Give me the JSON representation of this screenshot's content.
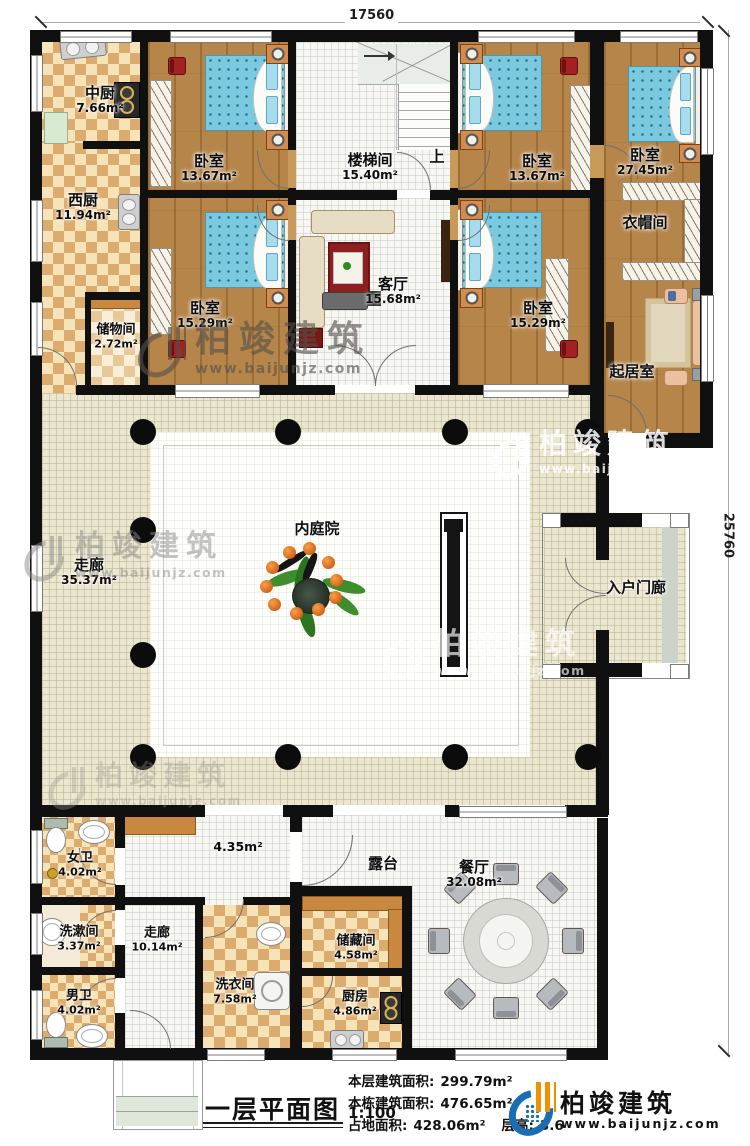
{
  "dimensions": {
    "top": "17560",
    "right": "25760"
  },
  "watermark": {
    "brand": "柏竣建筑",
    "url": "www.baijunjz.com"
  },
  "plan": {
    "up_label": "上"
  },
  "rooms": {
    "zhongchu": {
      "name": "中厨",
      "area": "7.66m²"
    },
    "xichu": {
      "name": "西厨",
      "area": "11.94m²"
    },
    "chuwujian": {
      "name": "储物间",
      "area": "2.72m²"
    },
    "bedroom_tl": {
      "name": "卧室",
      "area": "13.67m²"
    },
    "stairwell": {
      "name": "楼梯间",
      "area": "15.40m²"
    },
    "bedroom_tr": {
      "name": "卧室",
      "area": "13.67m²"
    },
    "bedroom_big": {
      "name": "卧室",
      "area": "27.45m²"
    },
    "cloakroom": {
      "name": "衣帽间"
    },
    "bedroom_ml": {
      "name": "卧室",
      "area": "15.29m²"
    },
    "keting": {
      "name": "客厅",
      "area": "15.68m²"
    },
    "bedroom_mr": {
      "name": "卧室",
      "area": "15.29m²"
    },
    "qijushi": {
      "name": "起居室"
    },
    "zoulang1": {
      "name": "走廊",
      "area": "35.37m²"
    },
    "neitingyuan": {
      "name": "内庭院"
    },
    "ruhumenlang": {
      "name": "入户门廊"
    },
    "nvwei": {
      "name": "女卫",
      "area": "4.02m²"
    },
    "xishujian": {
      "name": "洗漱间",
      "area": "3.37m²"
    },
    "nanwei": {
      "name": "男卫",
      "area": "4.02m²"
    },
    "zoulang2": {
      "name": "走廊",
      "area": "10.14m²"
    },
    "xiyijian": {
      "name": "洗衣间",
      "area": "7.58m²"
    },
    "hall": {
      "area": "4.35m²"
    },
    "cangchujian": {
      "name": "储藏间",
      "area": "4.58m²"
    },
    "chufang": {
      "name": "厨房",
      "area": "4.86m²"
    },
    "lutai": {
      "name": "露台"
    },
    "canting": {
      "name": "餐厅",
      "area": "32.08m²"
    }
  },
  "footer": {
    "title": "一层平面图",
    "scale": "1:100",
    "stats": [
      {
        "label": "本层建筑面积:",
        "value": "299.79m²"
      },
      {
        "label": "本栋建筑面积:",
        "value": "476.65m²"
      },
      {
        "label": "占地面积:",
        "value": "428.06m²"
      },
      {
        "label": "层高:",
        "value": "3.6"
      }
    ],
    "logo": {
      "brand": "柏竣建筑",
      "url": "www.baijunjz.com"
    }
  }
}
